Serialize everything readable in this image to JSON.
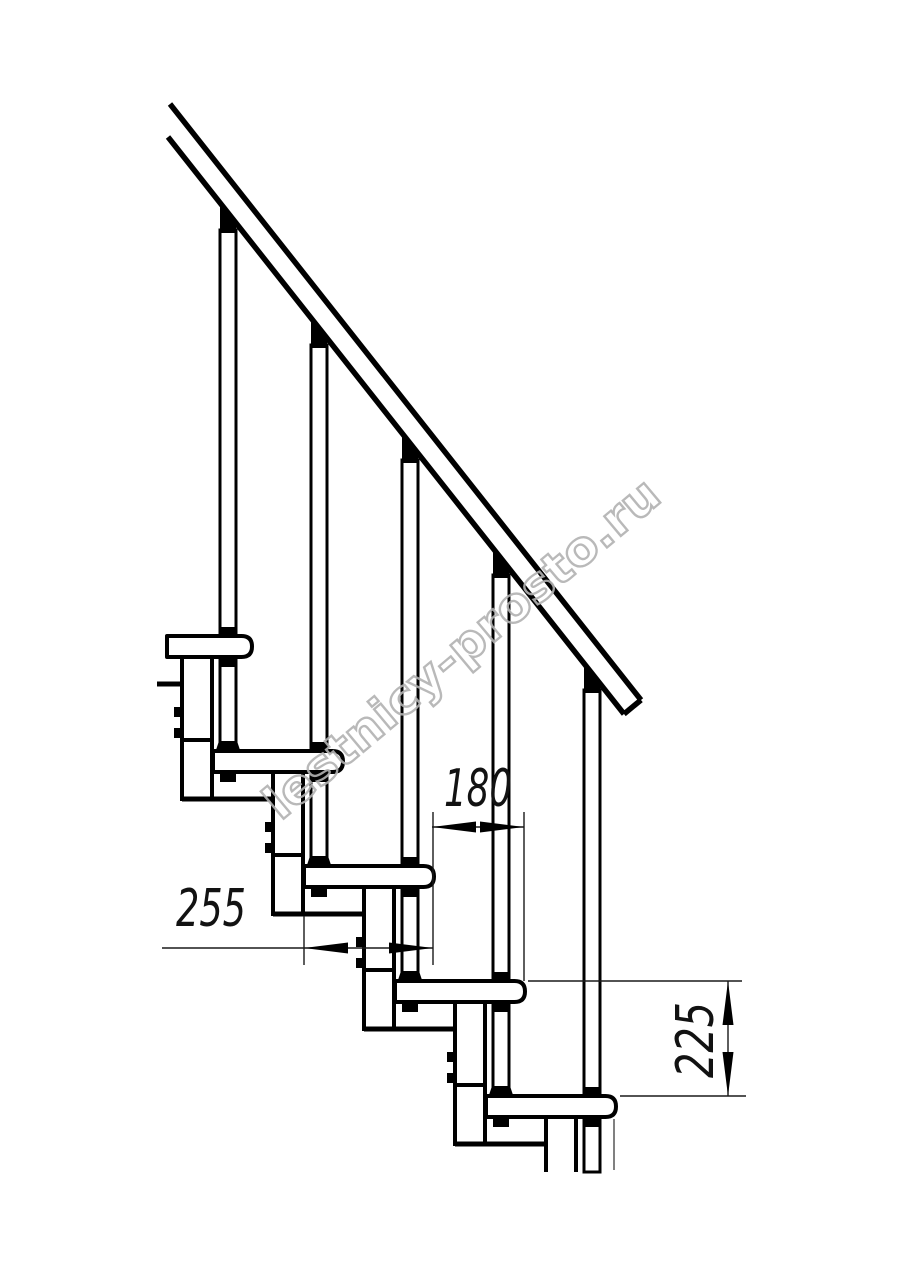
{
  "page": {
    "background": "#ffffff"
  },
  "drawing": {
    "line_color": "#000000",
    "dimensions": {
      "tread_depth": {
        "value": "255"
      },
      "run": {
        "value": "180"
      },
      "rise": {
        "value": "225"
      }
    },
    "watermark": {
      "text": "lestnicy-prosto.ru",
      "color": "#b2b2b2"
    }
  }
}
